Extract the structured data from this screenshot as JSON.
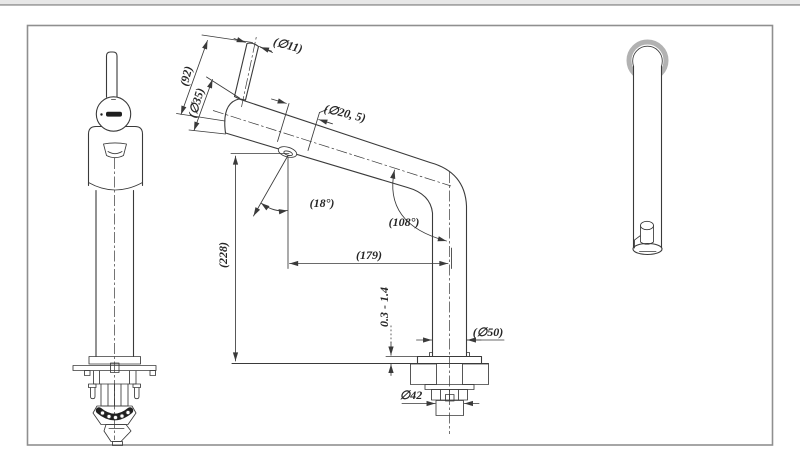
{
  "colors": {
    "line": "#3a3a3a",
    "dark": "#1f1f1f",
    "ring": "#b2b2b2",
    "frame": "#8f8f8f",
    "strip": "#e7e7e7",
    "strip_edge": "#a6a6a6",
    "background": "#ffffff"
  },
  "dims": {
    "lever_d": "(∅11)",
    "lever_len": "(92)",
    "body_d": "(∅35)",
    "spout_d": "(∅20, 5)",
    "outlet_angle": "(18°)",
    "bend_angle": "(108°)",
    "height": "(228)",
    "reach": "(179)",
    "deck": "0.3 - 1.4",
    "escutcheon_d": "(∅50)",
    "thread_d": "∅42"
  }
}
